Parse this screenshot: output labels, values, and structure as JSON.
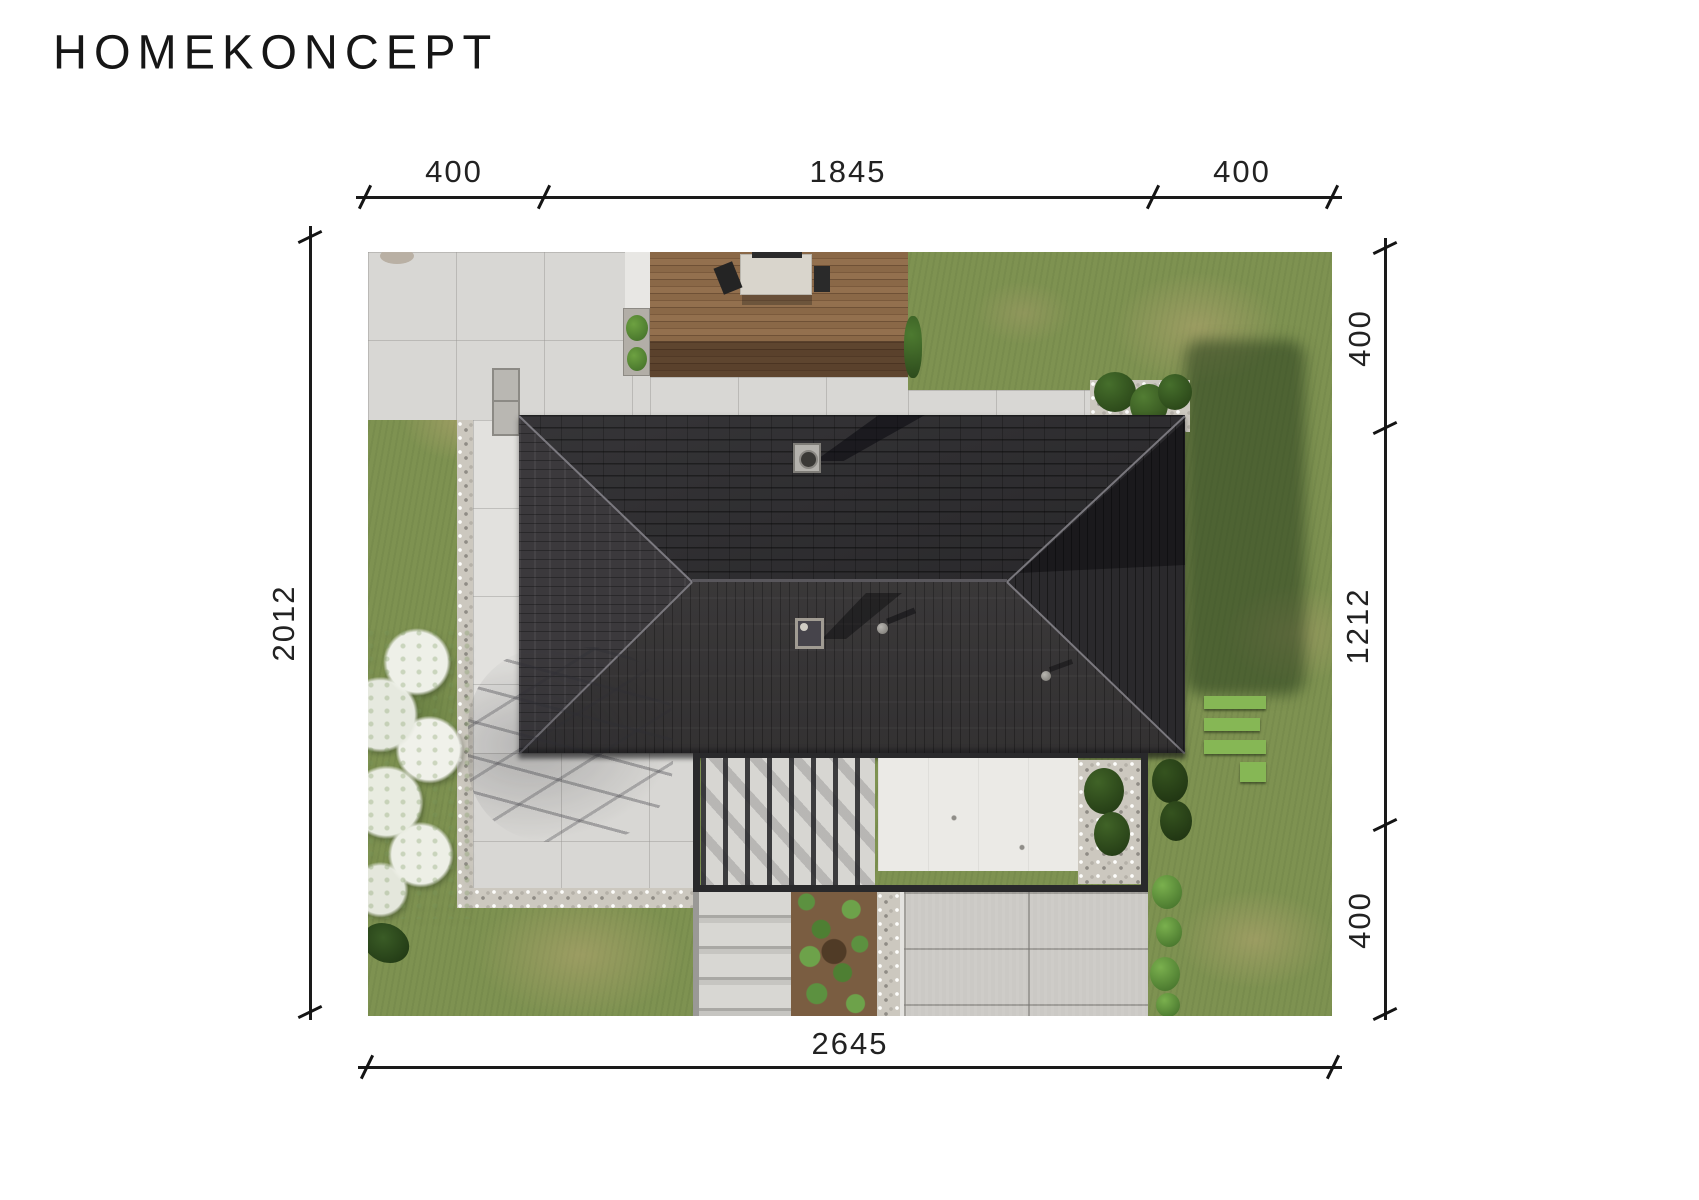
{
  "logo": {
    "text": "HOMEKONCEPT"
  },
  "dimensions": {
    "top": [
      "400",
      "1845",
      "400"
    ],
    "left": [
      "2012"
    ],
    "right": [
      "400",
      "1212",
      "400"
    ],
    "bottom": [
      "2645"
    ]
  },
  "colors": {
    "dimension_line": "#1a1a1a",
    "dimension_text": "#222222",
    "roof_dark": "#2b2a2d",
    "roof_light": "#3a3839",
    "grass": "#7e9251",
    "grass_shadow": "#3d5a2c",
    "pavement": "#d8d7d4",
    "deck_wood": "#8a6847",
    "canopy_white": "#ebeae6",
    "shrub_green": "#5c9140"
  }
}
